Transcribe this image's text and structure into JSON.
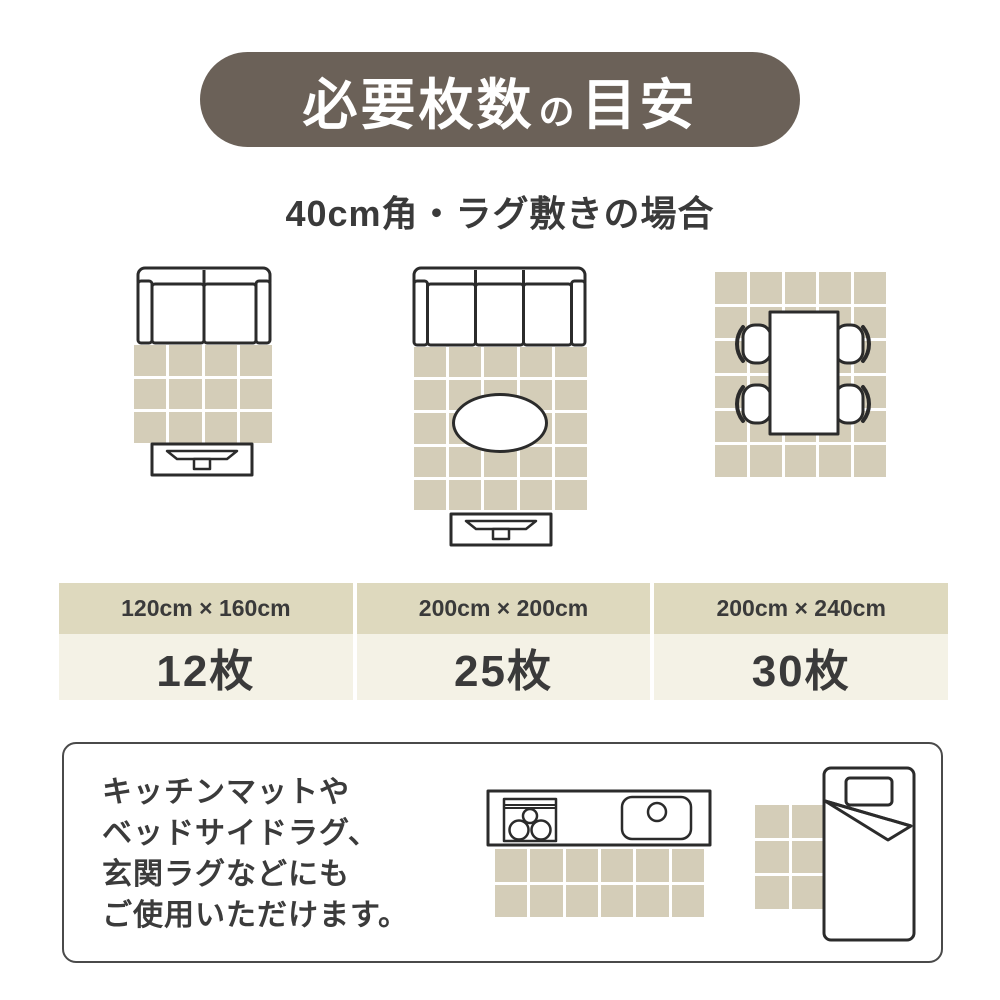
{
  "colors": {
    "banner_bg": "#6b6158",
    "banner_text": "#ffffff",
    "tile_beige": "#d4cdb8",
    "card_header_bg": "#ded9be",
    "card_body_bg": "#f4f2e6",
    "text_dark": "#3a3a3a",
    "line_dark": "#2b2b2b"
  },
  "banner": {
    "title_main": "必要枚数",
    "title_particle": "の",
    "title_sub": "目安"
  },
  "subtitle": "40cm角・ラグ敷きの場合",
  "layouts": [
    {
      "name": "sofa-2seat-rug",
      "size_label": "120cm × 160cm",
      "count_label": "12枚",
      "grid": {
        "cols": 4,
        "rows": 3
      }
    },
    {
      "name": "sofa-3seat-table-rug",
      "size_label": "200cm × 200cm",
      "count_label": "25枚",
      "grid": {
        "cols": 5,
        "rows": 5
      }
    },
    {
      "name": "dining-table-rug",
      "size_label": "200cm × 240cm",
      "count_label": "30枚",
      "grid": {
        "cols": 5,
        "rows": 6
      }
    }
  ],
  "note": {
    "lines": [
      "キッチンマットや",
      "ベッドサイドラグ、",
      "玄関ラグなどにも",
      "ご使用いただけます。"
    ],
    "kitchen_rug_grid": {
      "cols": 6,
      "rows": 2
    },
    "bedside_rug_grid": {
      "cols": 2,
      "rows": 3
    }
  }
}
